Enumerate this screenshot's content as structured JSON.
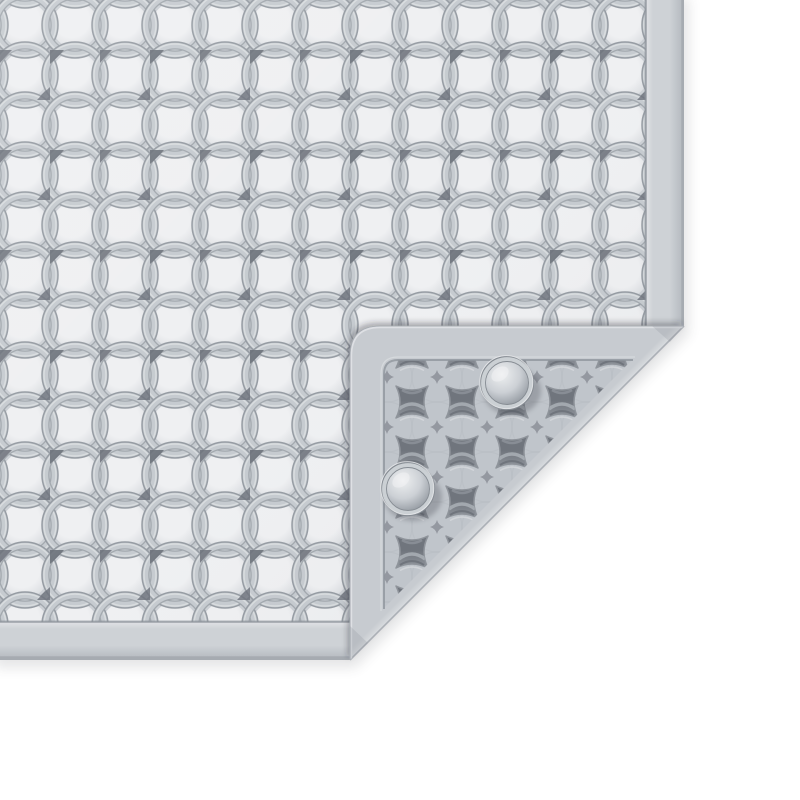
{
  "meta": {
    "title": "Light gray anti-slip mat with interlocking circle pattern, bottom-right corner folded over showing perforated back and two suction cups",
    "canvas_width": 800,
    "canvas_height": 800
  },
  "scene": {
    "object_type": "anti-slip-mat-product-render",
    "view": "top-down on white background",
    "front_face": {
      "pattern": "interlocking-circles-grid",
      "tile_pitch_px": 50,
      "ring_outer_radius_px": 33,
      "right_edge_x": 684,
      "bottom_edge_y": 660,
      "rim_width_px": 36
    },
    "fold": {
      "corner": "bottom-right",
      "crease_from": {
        "x": 684,
        "y": 326
      },
      "crease_to": {
        "x": 350,
        "y": 660
      },
      "flap_corner_radius_px": 30,
      "flap_rim_width_px": 34
    },
    "back_face": {
      "pattern": "perforated-pincushion-hole-grid",
      "hole_pitch_px": 50,
      "suction_cups": [
        {
          "id": "suction-cup-top",
          "x": 507,
          "y": 383,
          "outer_r": 26
        },
        {
          "id": "suction-cup-bottom",
          "x": 408,
          "y": 489,
          "outer_r": 26
        }
      ]
    }
  },
  "colors": {
    "background": "#ffffff",
    "matBase": "#ccd0d5",
    "pillowHi": "#eff0f2",
    "pillowMid": "#d7dade",
    "ringFace": "#c6cbd0",
    "ringLight": "#dcdfe2",
    "ringDark": "#969ca3",
    "ringInner": "#a2a8ae",
    "accentHole": "#6c717a",
    "rimFace": "#ced2d6",
    "rimLight": "#e0e2e5",
    "rimDark": "#b2b7bd",
    "rimEdge": "#a6abb1",
    "seam": "#8f959c",
    "flapBase": "#c7cbd0",
    "latticeBase": "#c0c5cb",
    "holeDark": "#70757d",
    "holeMid": "#8f949b",
    "holeLight": "#abb0b6",
    "creaseHi": "#d9dcdf",
    "cupFace": "#cbd0d4",
    "cupEdge": "#868c93",
    "domeHi": "#eef0f1",
    "domeMid": "#ccd0d5",
    "domeLo": "#9aa0a7",
    "shadow": "#3c4148"
  }
}
